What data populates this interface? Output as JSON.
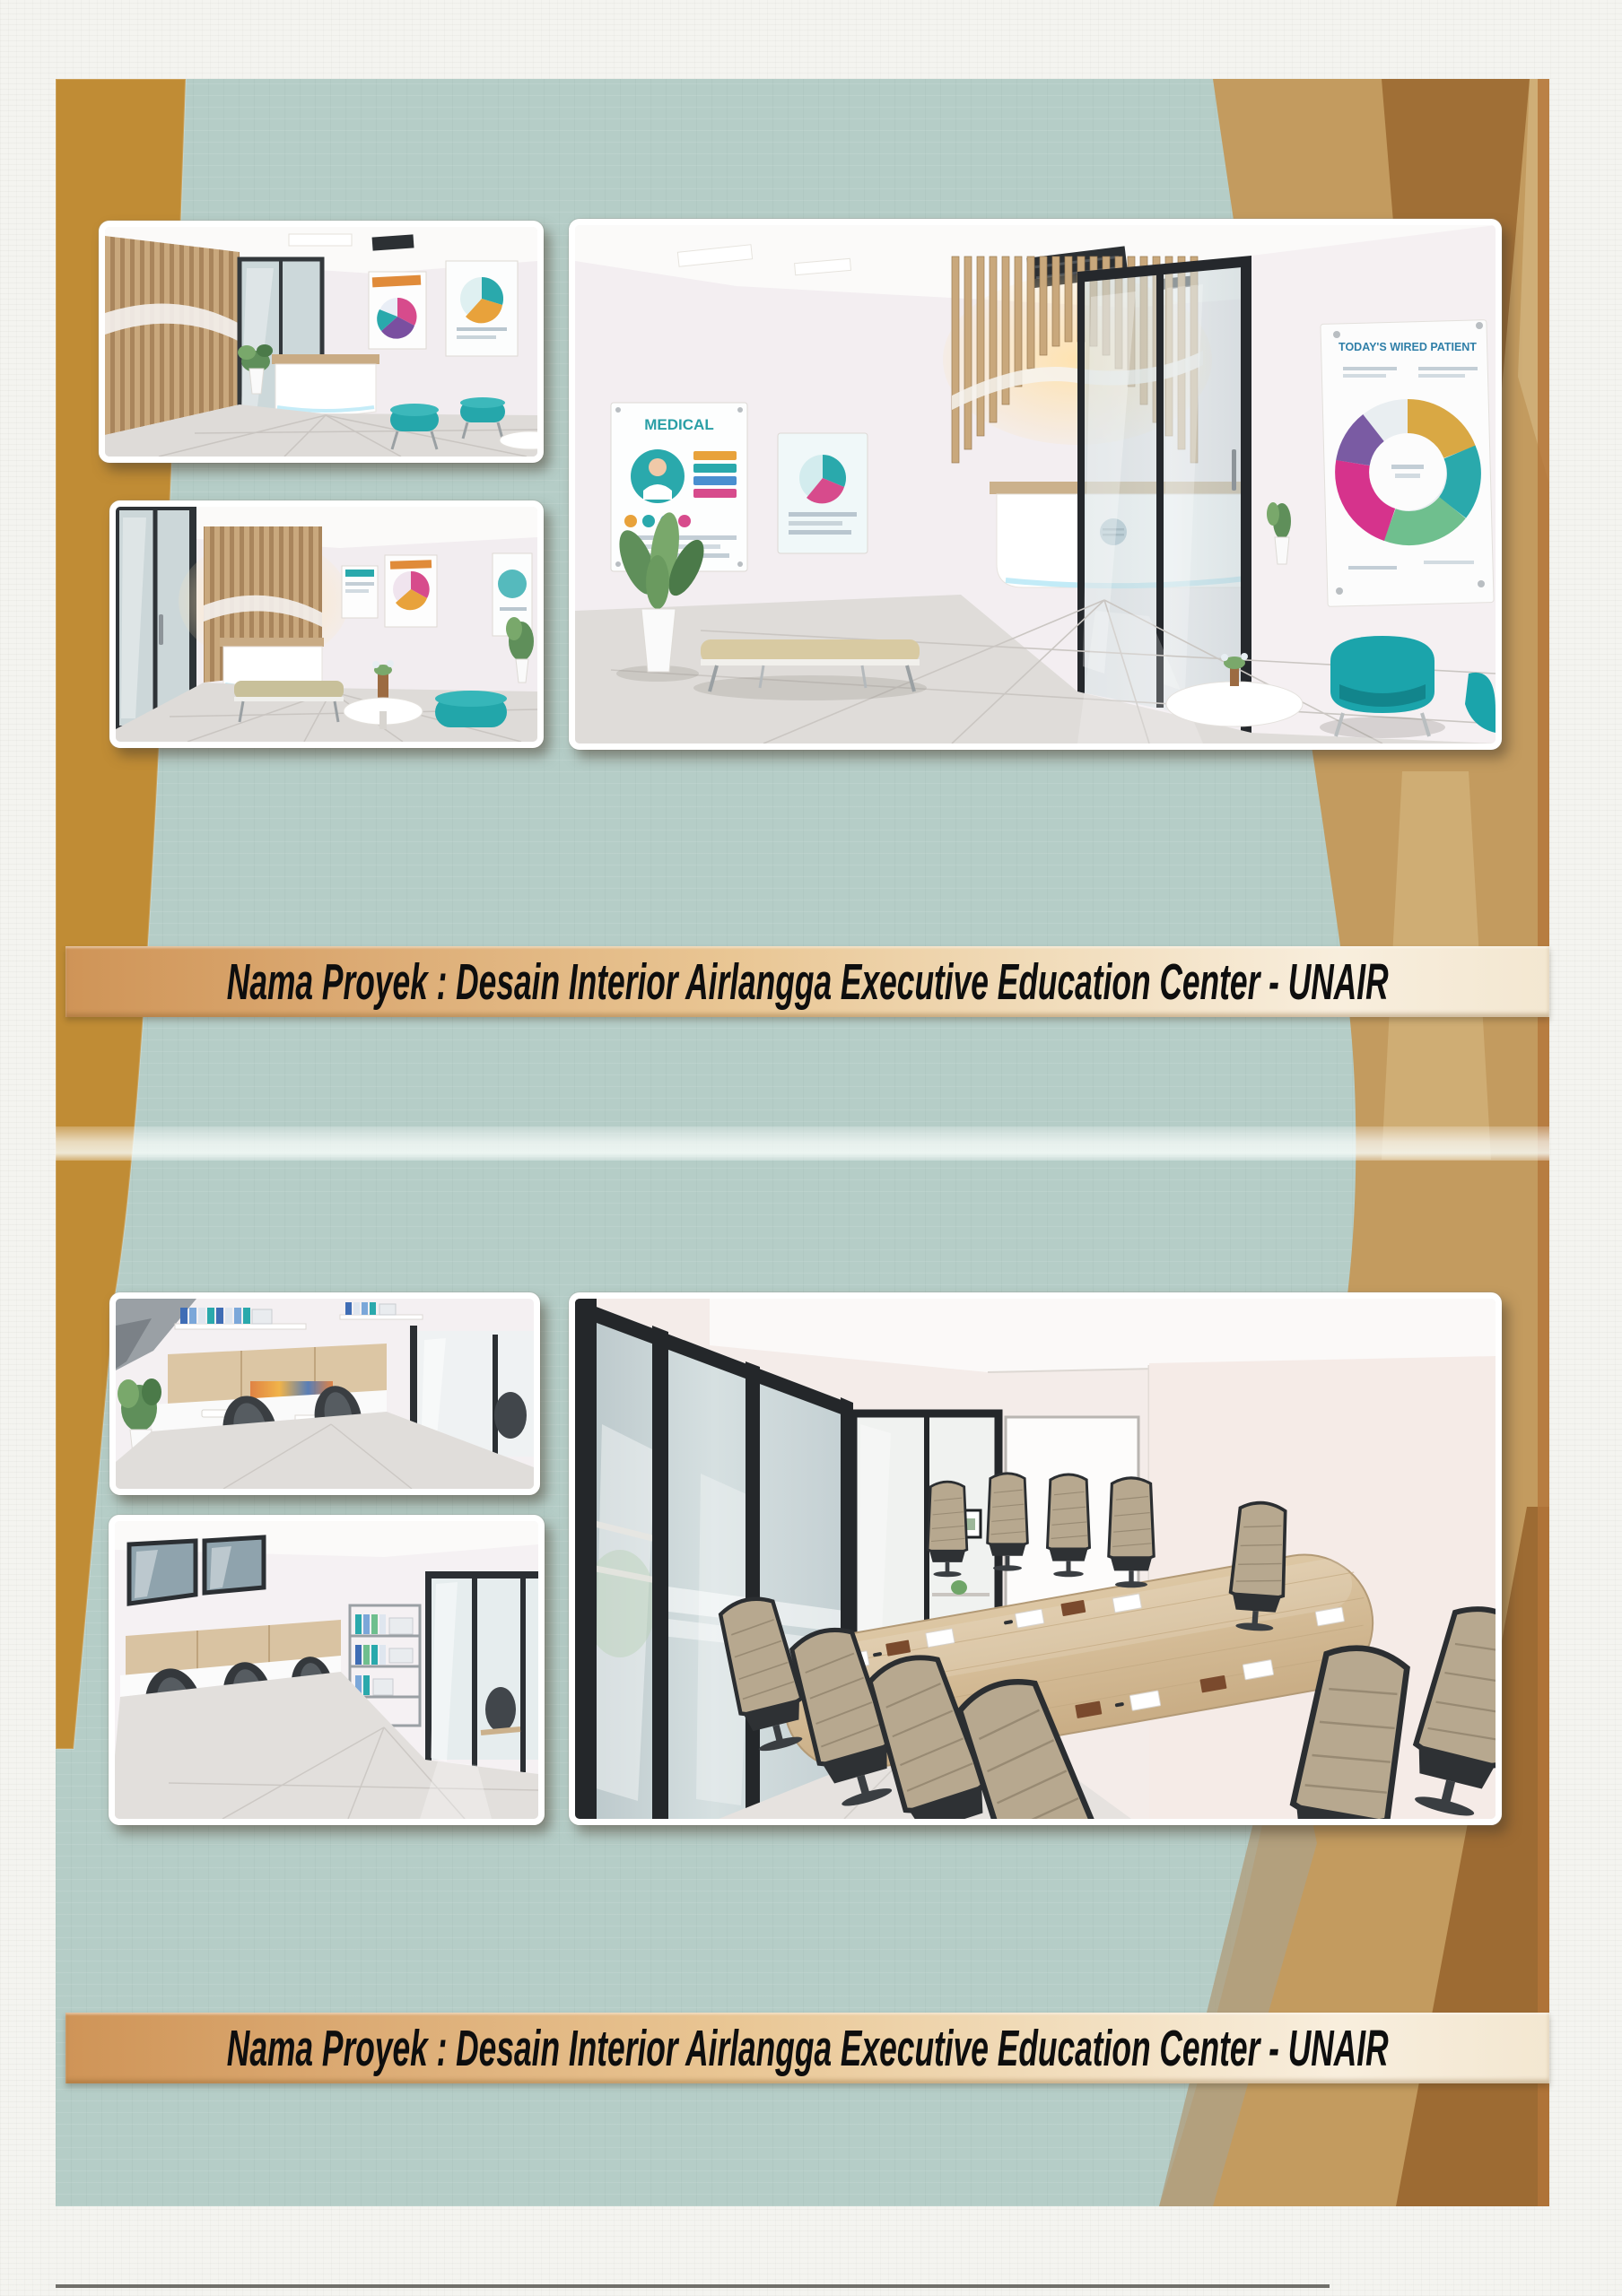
{
  "page": {
    "banner_top": {
      "text": "Nama Proyek : Desain Interior Airlangga Executive Education Center - UNAIR"
    },
    "banner_bottom": {
      "text": "Nama Proyek : Desain Interior Airlangga Executive Education Center - UNAIR"
    }
  },
  "posters": {
    "medical": "MEDICAL",
    "wired_patient": "TODAY'S WIRED PATIENT"
  },
  "colors": {
    "page_teal": "#b5cdc7",
    "ochre_left": "#c08c35",
    "tan_right": "#c39b5f",
    "dark_brown": "#9d6b33",
    "banner_left": "#cf9457",
    "banner_right": "#f8eedd",
    "accent_teal": "#1fa7ad",
    "wood": "#c9a87d"
  }
}
